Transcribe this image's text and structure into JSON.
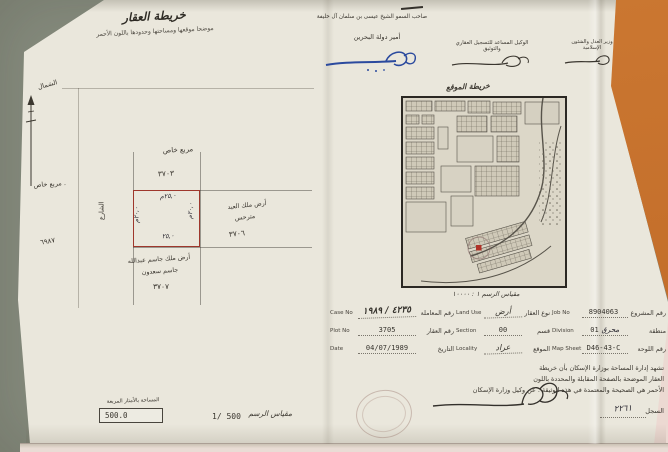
{
  "titles": {
    "map_title": "خريطة العقار",
    "map_subtitle": "موضحا موقعها ومساحتها وحدودها باللون الأحمر",
    "site_map_title": "خريطة الموقع",
    "site_map_scale": "مقياس الرسم  ١ : ١٠٠٠٠"
  },
  "header": {
    "ruler_name": "صاحب السمو الشيخ عيسى بن سلمان آل خليفة",
    "ruler_title": "أمير دولة البحرين",
    "registrar_title": "الوكيل المساعد للتسجيل العقاري والتوثيق",
    "minister_title": "وزير العدل والشئون الإسلامية"
  },
  "plot": {
    "north_label": "الشمال",
    "label_private_top": "مربع خاص",
    "label_private_left": ". مربع خاص",
    "street_label": "الشارع",
    "block_no_top": "٣٧٠٣",
    "block_no_right": "٣٧٠٦",
    "block_no_bottom": "٣٧٠٧",
    "survey_no_left": "٦٩٨٧",
    "dim_top": "٢٥,٠م",
    "dim_bottom": "٢٥,٠",
    "dim_left": "٢٠,٠م",
    "dim_right": "٢٠,٠م",
    "neighbor_right_line1": "أرض ملك العبد",
    "neighbor_right_line2": "مترحس",
    "neighbor_bottom_line1": "أرض ملك جاسم عبدالله",
    "neighbor_bottom_line2": "جاسم سعدون"
  },
  "area": {
    "label": "المساحة بالأمتار المربعة",
    "value": "500.0",
    "scale_value": "1/ 500",
    "scale_label": "مقياس الرسم"
  },
  "table": {
    "rows": [
      {
        "en1": "Case No",
        "v1": "٤٢٣٥ / ١٩٨٩",
        "ar1": "رقم المعاملة",
        "en2": "Land Use",
        "v2": "أرض",
        "ar2": "نوع العقار",
        "en3": "Job No",
        "v3": "8904063",
        "hand3": "",
        "ar3": "رقم المشروع"
      },
      {
        "en1": "Plot No",
        "v1": "3705",
        "ar1": "رقم العقار",
        "en2": "Section",
        "v2": "00",
        "ar2": "قسم",
        "en3": "Division",
        "v3": "01",
        "hand3": "محرق",
        "ar3": "منطقة"
      },
      {
        "en1": "Date",
        "v1": "04/07/1989",
        "ar1": "التاريخ",
        "en2": "Locality",
        "v2": "عراد",
        "ar2": "الموقع",
        "en3": "Map Sheet",
        "v3": "D46-43-C",
        "hand3": "",
        "ar3": "رقم اللوحة"
      }
    ]
  },
  "certification": {
    "line1": "تشهد إدارة المساحة بوزارة الإسكان بأن خريطة",
    "line2": "العقار الموضحة بالصفحة المقابلة والمحددة باللون",
    "line3": "الأحمر هي الصحيحة والمعتمدة في هذه الوثيقة . عن وكيل وزارة الإسكان",
    "register_label": "السجل",
    "register_value": "٢٢٦١"
  },
  "colors": {
    "plot_outline_red": "#9e372c",
    "marker_red": "#b03228",
    "signature_blue": "#2b4a9e",
    "backdrop_orange": "#c9742f",
    "backdrop_pink": "#ecd9d2",
    "backdrop_gray": "#868c7e",
    "paper": "#eae7dc"
  }
}
